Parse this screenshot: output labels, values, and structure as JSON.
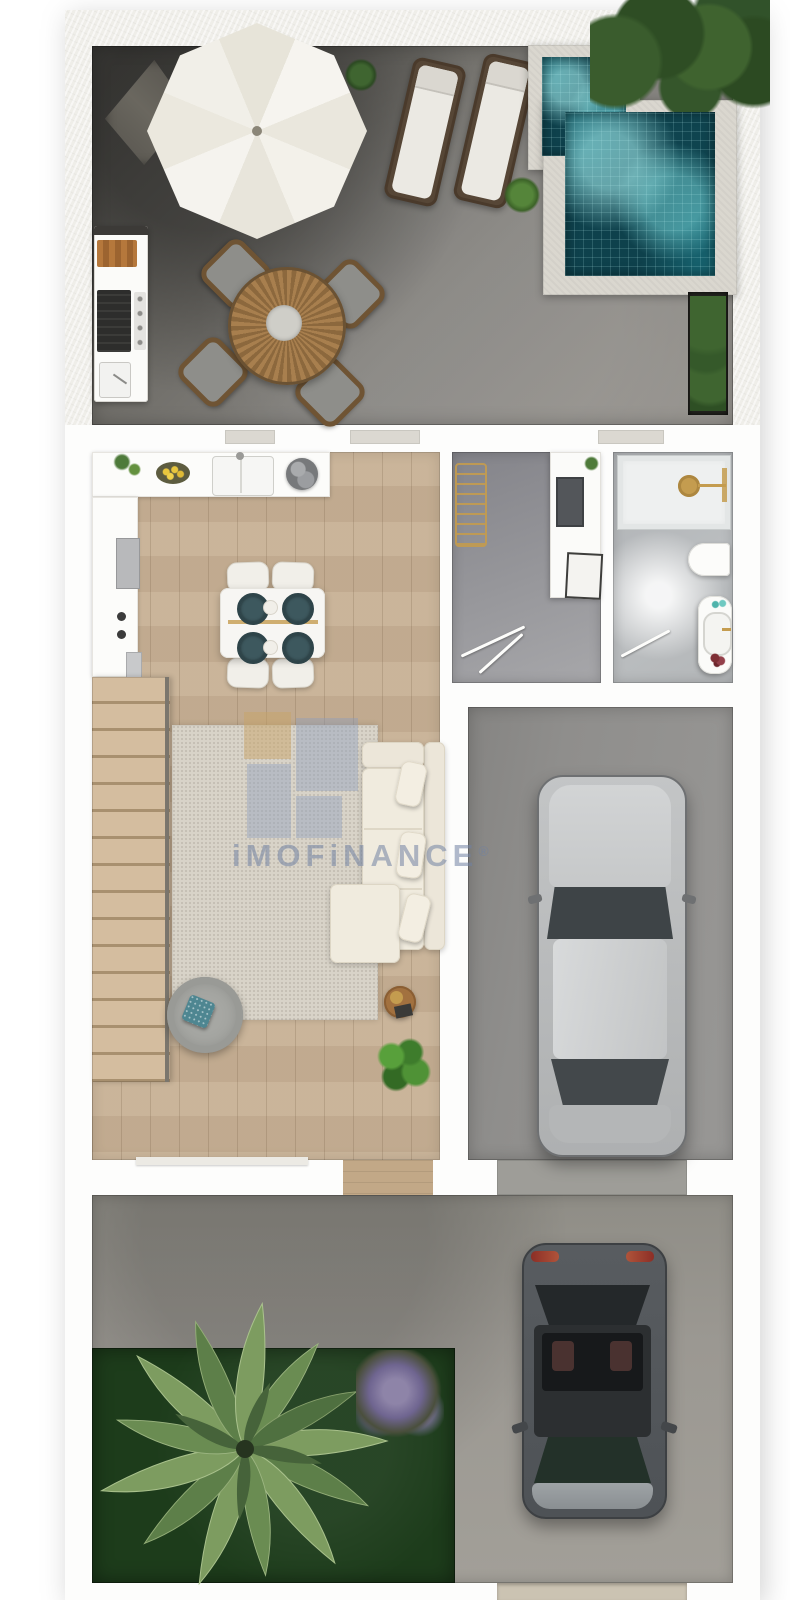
{
  "watermark": {
    "text": "iMOFiNANCE",
    "registered": "®"
  },
  "colors": {
    "wood": "#c7b094",
    "terrace-dark": "#4c4b47",
    "terrace-light": "#97948f",
    "water": "#16606c",
    "grass": "#1d3c1b",
    "concrete": "#a29f98",
    "garage": "#989795",
    "rug": "#d8d3c8",
    "sofa": "#ece6d9",
    "gold": "#c49c4f"
  },
  "floorplan": {
    "type": "3d-top-down-floor-plan",
    "sections": [
      {
        "id": "roof-terrace",
        "items": [
          "cantilever-parasol",
          "parasol-base",
          "outdoor-kitchen-bbq",
          "round-dining-table",
          "four-outdoor-chairs",
          "two-sun-loungers",
          "small-plunge-pool",
          "large-plunge-pool",
          "hedge-plants",
          "planter-box",
          "round-shrubs"
        ]
      },
      {
        "id": "main-floor",
        "rooms": [
          {
            "id": "kitchen-living-room",
            "items": [
              "l-shaped-kitchen-counter",
              "double-sink",
              "fruit-bowl",
              "cooktop",
              "fridge",
              "dining-table-for-four",
              "staircase",
              "area-rug",
              "l-shaped-sofa",
              "round-armchair",
              "side-table",
              "potted-plant"
            ]
          },
          {
            "id": "utility-room",
            "items": [
              "drying-rack",
              "counter-with-sink",
              "door"
            ]
          },
          {
            "id": "bathroom",
            "items": [
              "walk-in-shower",
              "toilet",
              "vanity-with-basin",
              "door"
            ]
          },
          {
            "id": "garage",
            "items": [
              "silver-car"
            ]
          }
        ]
      },
      {
        "id": "yard",
        "items": [
          "lawn",
          "palm-tree",
          "lavender-bush",
          "driveway",
          "dark-gray-car",
          "gate-opening"
        ]
      }
    ]
  }
}
